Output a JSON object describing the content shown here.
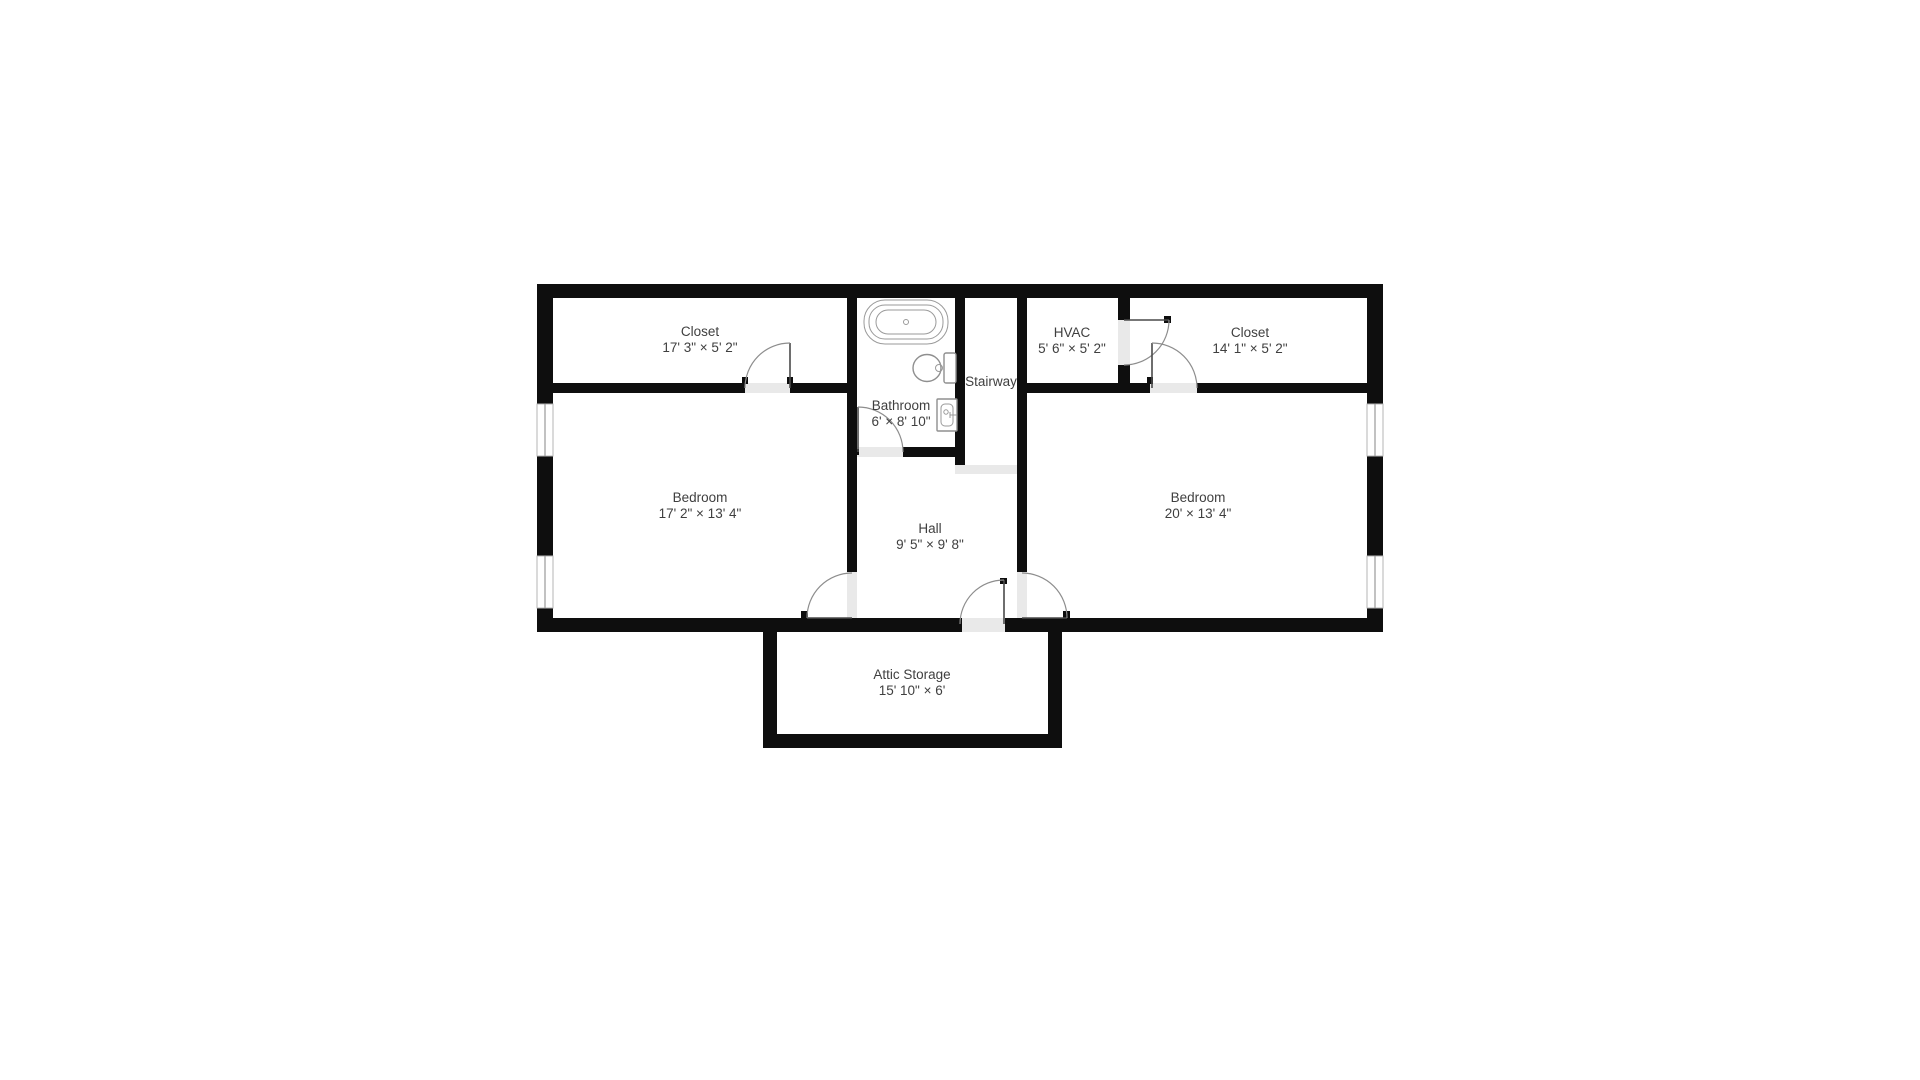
{
  "floorplan": {
    "rooms": [
      {
        "id": "closet-left",
        "name": "Closet",
        "dims": "17' 3\" × 5' 2\""
      },
      {
        "id": "bathroom",
        "name": "Bathroom",
        "dims": "6' × 8' 10\""
      },
      {
        "id": "stairway",
        "name": "Stairway",
        "dims": ""
      },
      {
        "id": "hvac",
        "name": "HVAC",
        "dims": "5' 6\" × 5' 2\""
      },
      {
        "id": "closet-right",
        "name": "Closet",
        "dims": "14' 1\" × 5' 2\""
      },
      {
        "id": "bedroom-left",
        "name": "Bedroom",
        "dims": "17' 2\" × 13' 4\""
      },
      {
        "id": "hall",
        "name": "Hall",
        "dims": "9' 5\" × 9' 8\""
      },
      {
        "id": "bedroom-right",
        "name": "Bedroom",
        "dims": "20' × 13' 4\""
      },
      {
        "id": "attic-storage",
        "name": "Attic Storage",
        "dims": "15' 10\" × 6'"
      }
    ],
    "fixtures": [
      "bathtub",
      "toilet",
      "sink"
    ],
    "colors": {
      "wall": "#0e0e0e",
      "label": "#3f3f3f",
      "door_arc": "#8d8d8d",
      "door_leaf": "#4a4a4a",
      "threshold": "#e9e9e9",
      "background": "#ffffff"
    }
  }
}
